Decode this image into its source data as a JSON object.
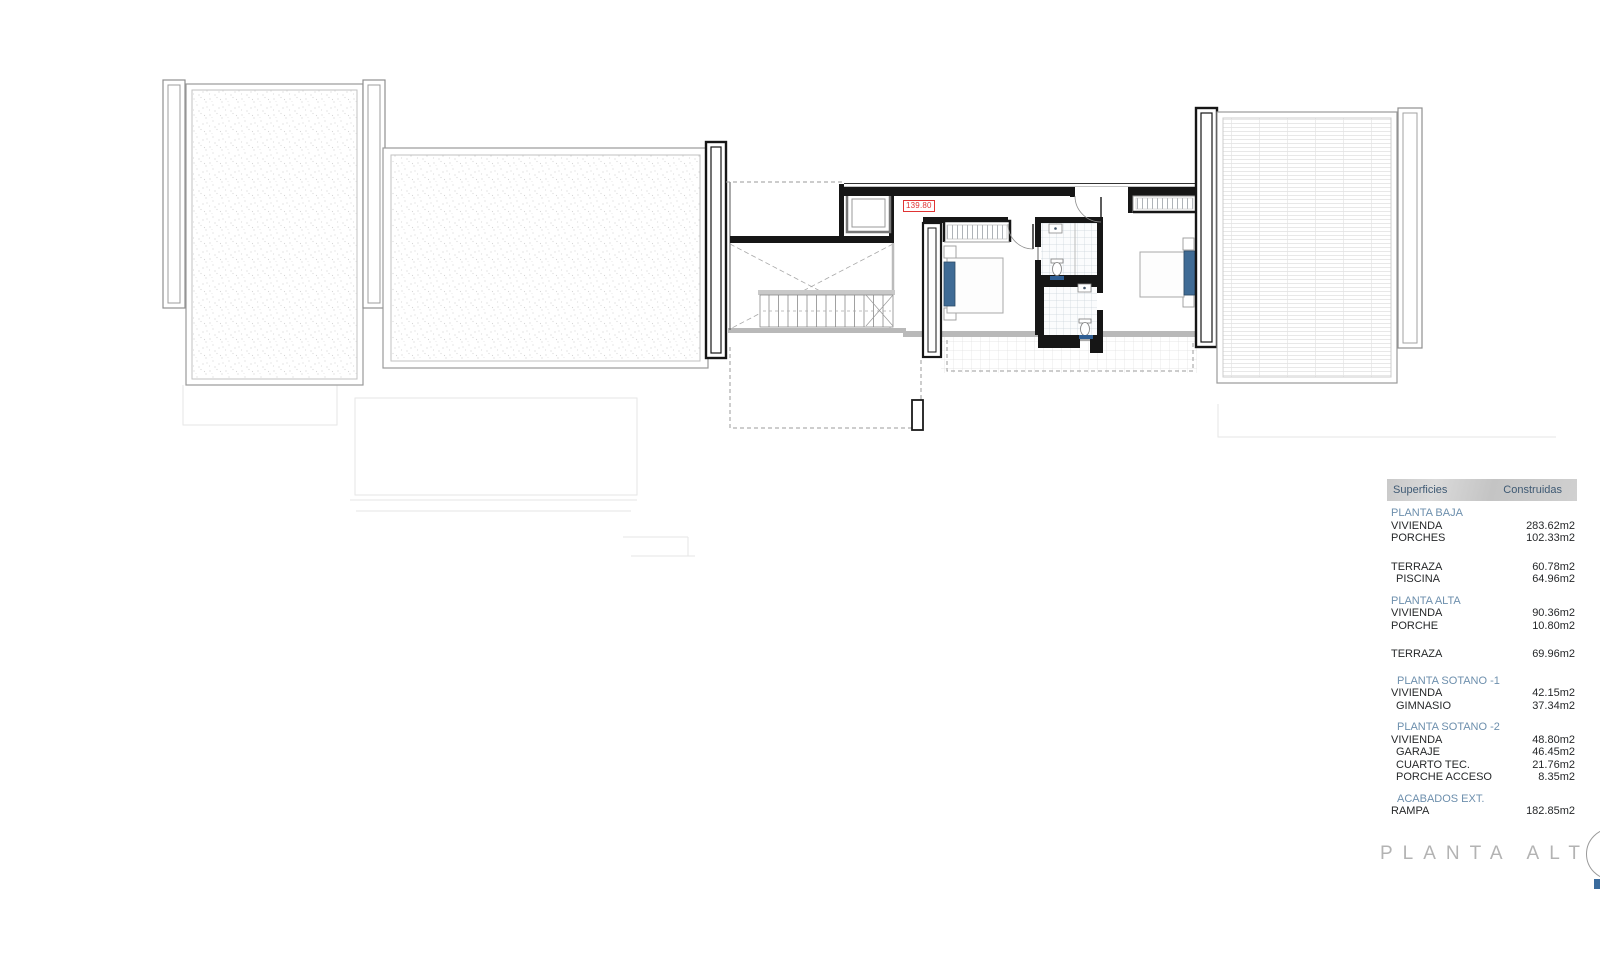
{
  "plan": {
    "dimension_label": "139.80",
    "title_word1": "PLANTA",
    "title_word2": "ALTA"
  },
  "surface_table": {
    "col_label": "Superficies",
    "col_value": "Construidas",
    "sections": [
      {
        "title": "PLANTA BAJA",
        "rows": [
          {
            "label": "VIVIENDA",
            "value": "283.62m2"
          },
          {
            "label": "PORCHES",
            "value": "102.33m2"
          }
        ]
      },
      {
        "title": "",
        "rows": [
          {
            "label": "TERRAZA",
            "value": "60.78m2"
          },
          {
            "label": "PISCINA",
            "value": "64.96m2"
          }
        ]
      },
      {
        "title": "PLANTA ALTA",
        "rows": [
          {
            "label": "VIVIENDA",
            "value": "90.36m2"
          },
          {
            "label": "PORCHE",
            "value": "10.80m2"
          }
        ]
      },
      {
        "title": "",
        "rows": [
          {
            "label": "TERRAZA",
            "value": "69.96m2"
          }
        ]
      },
      {
        "title": "PLANTA SOTANO -1",
        "rows": [
          {
            "label": "VIVIENDA",
            "value": "42.15m2"
          },
          {
            "label": "GIMNASIO",
            "value": "37.34m2"
          }
        ]
      },
      {
        "title": "PLANTA SOTANO -2",
        "rows": [
          {
            "label": "VIVIENDA",
            "value": "48.80m2"
          },
          {
            "label": "GARAJE",
            "value": "46.45m2"
          },
          {
            "label": "CUARTO TEC.",
            "value": "21.76m2"
          },
          {
            "label": "PORCHE ACCESO",
            "value": "8.35m2"
          }
        ]
      },
      {
        "title": "ACABADOS EXT.",
        "rows": [
          {
            "label": "RAMPA",
            "value": "182.85m2"
          }
        ]
      }
    ]
  }
}
